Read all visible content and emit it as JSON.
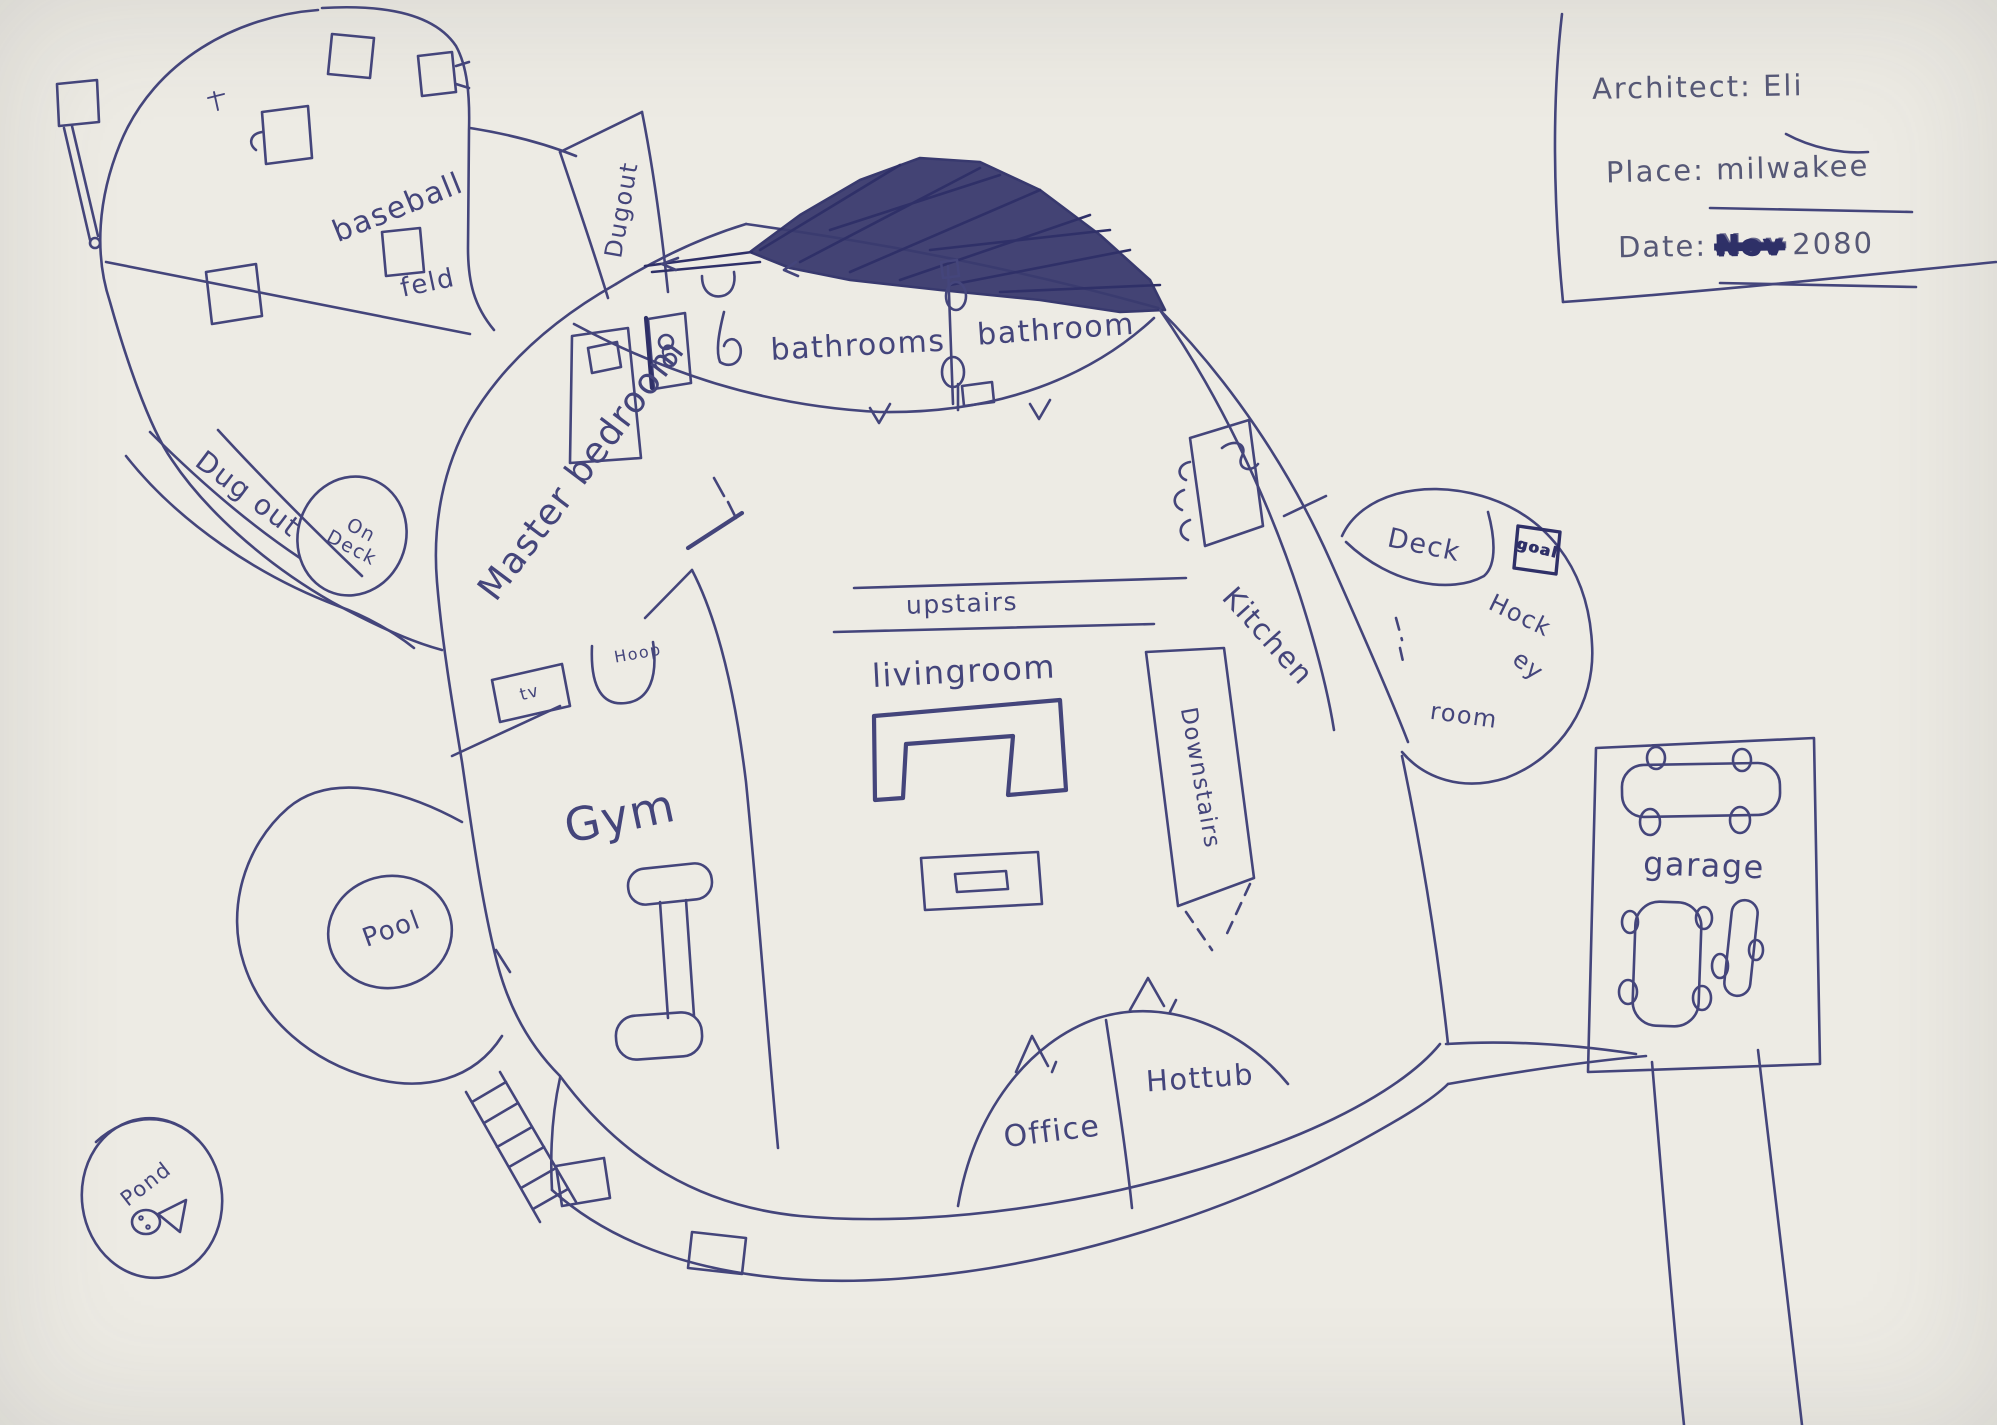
{
  "palette": {
    "pen": "#44457b",
    "pen_dark": "#2f3068",
    "paper": "#edebe4"
  },
  "title_box": {
    "architect_label": "Architect:",
    "architect_name": "Eli",
    "place_label": "Place:",
    "place_value": "milwakee",
    "date_label": "Date:",
    "date_month": "Nov",
    "date_year": "2080"
  },
  "labels": {
    "baseball_word1": "baseball",
    "baseball_word2": "feld",
    "dugout_top": "Dugout",
    "dugout_left": "Dug out",
    "on_deck_line1": "On",
    "on_deck_line2": "Deck",
    "master_bedroom": "Master bedroom",
    "bathrooms": "bathrooms",
    "bathroom": "bathroom",
    "upstairs": "upstairs",
    "livingroom": "livingroom",
    "kitchen": "Kitchen",
    "deck": "Deck",
    "goal": "goal",
    "hockey_line1": "Hock",
    "hockey_line2": "ey",
    "hockey_line3": "room",
    "downstairs": "Downstairs",
    "gym": "Gym",
    "tv": "tv",
    "hoop": "Hoop",
    "pool": "Pool",
    "pond": "Pond",
    "office": "Office",
    "hottub": "Hottub",
    "garage": "garage"
  }
}
